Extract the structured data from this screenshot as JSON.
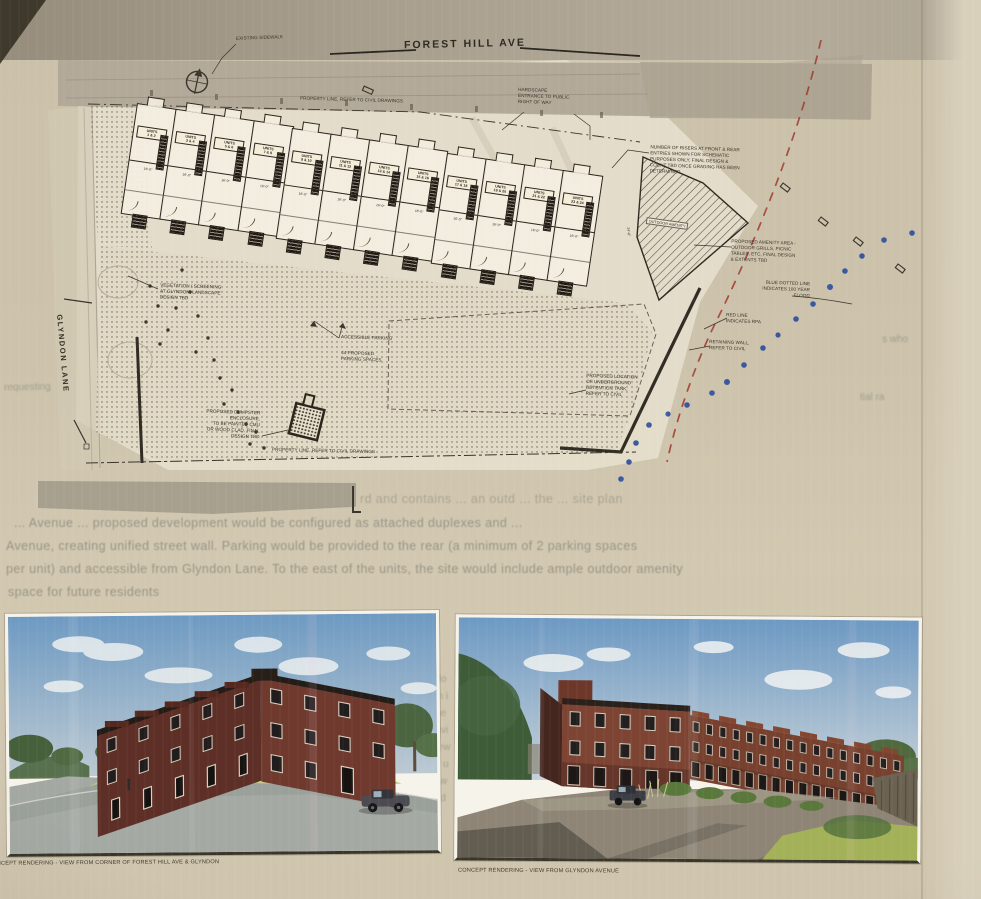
{
  "plan": {
    "street_top": "FOREST HILL AVE",
    "street_left": "GLYNDON LANE",
    "units_word": "UNITS",
    "units": [
      "1 & 2",
      "3 & 4",
      "5 & 6",
      "7 & 8",
      "9 & 10",
      "11 & 12",
      "13 & 14",
      "15 & 16",
      "17 & 18",
      "19 & 20",
      "21 & 22",
      "23 & 24"
    ],
    "unit_dim": "16'-0\"",
    "end_dim": "24'-6\"",
    "amenity_hatch_label": "OUTDOOR AMENITY",
    "annotations": {
      "existing_sidewalk": "EXISTING SIDEWALK",
      "property_line_top": "PROPERTY LINE, REFER TO CIVIL DRAWINGS",
      "hardscape": "HARDSCAPE\nENTRANCE TO PUBLIC\nRIGHT OF WAY",
      "risers": "NUMBER OF RISERS AT FRONT & REAR\nENTRIES SHOWN FOR SCHEMATIC\nPURPOSES ONLY, FINAL DESIGN &\nCOUNT TBD ONCE GRADING HAS BEEN\nDETERMINED",
      "amenity": "PROPOSED AMENITY AREA -\nOUTDOOR GRILLS, PICNIC\nTABLES, ETC, FINAL DESIGN\n& EXTENTS TBD",
      "flood": "BLUE DOTTED LINE\nINDICATES 100 YEAR\nFLOOD",
      "rpa": "RED LINE\nINDICATES RPA",
      "retaining": "RETAINING WALL,\nREFER TO CIVIL",
      "detention": "PROPOSED LOCATION\nOF UNDERGROUND\nDETENTION TANK,\nREFER TO CIVIL",
      "accessible": "ACCESSIBLE PARKING",
      "parking_count": "44 PROPOSED\nPARKING SPACES",
      "vegetation": "VEGETATION / SCREENING\nAT GLYNDON, LANDSCAPE\nDESIGN TBD",
      "dumpster": "PROPOSED DUMPSTER\nENCLOSURE,\nTO BE PAINTED CMU\nOR WOOD CLAD, FINAL\nDESIGN TBD",
      "property_line_bottom": "PROPERTY LINE, REFER TO CIVIL DRAWINGS"
    },
    "colors": {
      "flood_dot": "#2d4f9e",
      "rpa_line": "#9e382c",
      "ink": "#3a332a",
      "paper": "#cdc3ac"
    }
  },
  "bleed": {
    "paragraph": [
      "rd and contains ... an outd ... the ... site plan",
      "... Avenue ... proposed development would be configured as attached duplexes and ...",
      "Avenue, creating unified street wall. Parking would be provided to the rear (a minimum of 2 parking spaces",
      "per unit) and accessible from Glyndon Lane. To the east of the units, the site would include ample outdoor amenity",
      "space for future residents"
    ],
    "fragments_left": [
      "requesting"
    ],
    "fragments_right": [
      "s who",
      "tial ra"
    ],
    "fragments_column": [
      "st",
      "tl",
      "rdo",
      "on i",
      "the",
      "revi",
      "new",
      "of u",
      "it w",
      "ted"
    ]
  },
  "renderings": {
    "left_caption": "CONCEPT RENDERING - VIEW FROM CORNER OF FOREST HILL AVE & GLYNDON",
    "right_caption": "CONCEPT RENDERING - VIEW FROM GLYNDON AVENUE"
  }
}
